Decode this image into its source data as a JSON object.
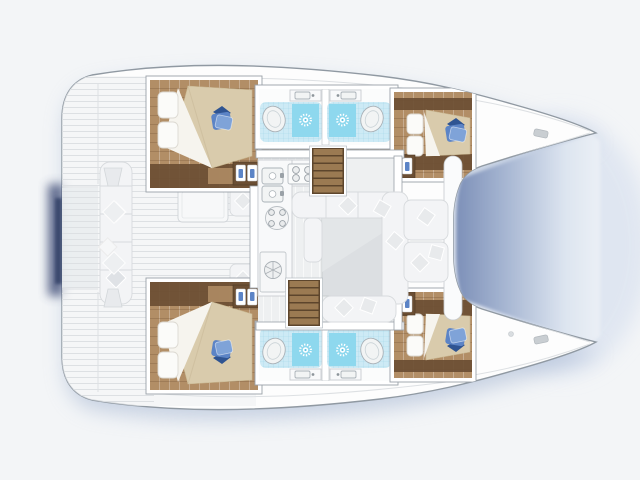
{
  "title": "Catamaran yacht interior floor plan, top view, bow to the right",
  "colors": {
    "bg": "#f3f5f7",
    "wash": "#dbe3f0",
    "shadow_blue": "#a9b9d4",
    "shadow_navy": "#3f4e77",
    "hull_fill": "#fdfdfd",
    "hull_stroke": "#9099a2",
    "deck_line": "#dde0e3",
    "wood_mid": "#b28e66",
    "wood_dark": "#6b4e33",
    "duvet": "#d9cbac",
    "sheet": "#f6f4ee",
    "pillow_white": "#fbfbf9",
    "pillow_blue_dark": "#2f5492",
    "pillow_blue_mid": "#5c84c6",
    "pillow_blue_light": "#7fa3d8",
    "tile_base": "#cdeaf5",
    "tile_line": "#a6d7e9",
    "tile_shower": "#8ed8ee",
    "shower_core": "#5fc3e2",
    "fixture_fill": "#f2f4f4",
    "fixture_stroke": "#aab2b8",
    "wall_stroke": "#9aa1a8",
    "salon_floor": "#eef0f1",
    "seat": "#f3f4f6",
    "seat_stroke": "#d7dadd",
    "pillow_gray": "#e8eaec",
    "table": "#dcdfe2",
    "counter_fill": "#f8f9fa",
    "counter_stroke": "#c9cdd1",
    "stair_tread": "#9b7a52",
    "stair_dark": "#5d452c",
    "water_deep": "#8093ba",
    "water_mid": "#aab9d4",
    "water_light": "#dde5f0",
    "water_pale": "#f1f4f8"
  },
  "labels": {
    "boat": "catamaran floor plan",
    "port_hull": "port hull: aft cabin, two bathrooms, forward cabin",
    "starboard_hull": "starboard hull: aft cabin, two bathrooms, forward cabin",
    "salon": "salon with galley and dining table",
    "galley": "galley: double sink, stove, round hob, fridge",
    "aft_cockpit": "aft cockpit with bench, pillows and table",
    "fwd_cockpit": "forward cockpit bench seats",
    "stairs": "companionway stairs to hull",
    "water": "water between the bows",
    "cabin": "double-bed cabin with blue pillow",
    "bathroom": "bathroom: toilet, shower, washbasin"
  },
  "legend": {
    "icons": [
      "shower-sun-icon",
      "toilet-icon",
      "washbasin-icon",
      "stove-burner-icon",
      "sink-icon",
      "fridge-hatch-icon",
      "stairs-icon",
      "bed-icon",
      "pillow-icon",
      "cleat-icon"
    ],
    "rooms": [
      {
        "name": "aft-cabin-port",
        "fixtures": [
          "double-bed",
          "blue-pillow",
          "wardrobe-cubby"
        ]
      },
      {
        "name": "bathroom-port-aft",
        "fixtures": [
          "toilet",
          "shower",
          "washbasin"
        ]
      },
      {
        "name": "bathroom-port-fwd",
        "fixtures": [
          "toilet",
          "shower",
          "washbasin"
        ]
      },
      {
        "name": "forward-cabin-port",
        "fixtures": [
          "double-bed",
          "blue-pillow",
          "wardrobe-cubby"
        ]
      },
      {
        "name": "aft-cabin-starboard",
        "fixtures": [
          "double-bed",
          "blue-pillow",
          "wardrobe-cubby"
        ]
      },
      {
        "name": "bathroom-starboard-aft",
        "fixtures": [
          "toilet",
          "shower",
          "washbasin"
        ]
      },
      {
        "name": "bathroom-starboard-fwd",
        "fixtures": [
          "toilet",
          "shower",
          "washbasin"
        ]
      },
      {
        "name": "forward-cabin-starboard",
        "fixtures": [
          "double-bed",
          "blue-pillow",
          "wardrobe-cubby"
        ]
      },
      {
        "name": "salon",
        "fixtures": [
          "galley-counter",
          "stove",
          "double-sink",
          "round-hob",
          "fridge",
          "dining-table",
          "sofa",
          "stairs-x2"
        ]
      },
      {
        "name": "aft-cockpit",
        "fixtures": [
          "bench",
          "table",
          "steps"
        ]
      },
      {
        "name": "forward-cockpit",
        "fixtures": [
          "bench-x2"
        ]
      }
    ]
  }
}
